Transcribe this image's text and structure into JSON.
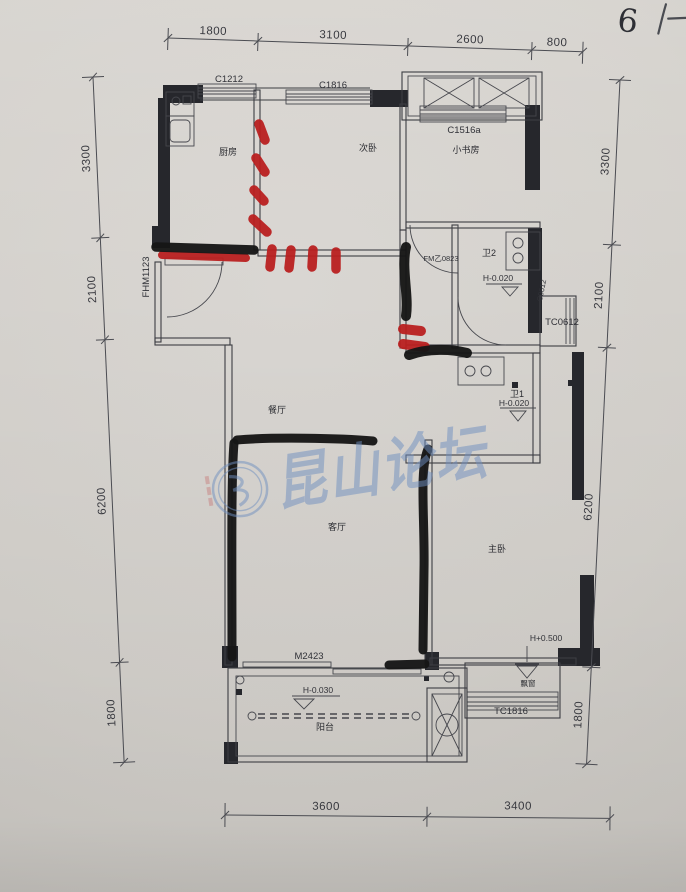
{
  "photo": {
    "handwritten_note": "6"
  },
  "watermark": {
    "text": "昆山论坛"
  },
  "rooms": {
    "kitchen": "厨房",
    "bedroom2": "次卧",
    "study": "小书房",
    "bath2": "卫2",
    "bath1": "卫1",
    "dining": "餐厅",
    "living": "客厅",
    "master": "主卧",
    "balcony": "阳台",
    "bay": "飘窗"
  },
  "openings": {
    "win_c1212": "C1212",
    "win_c1816": "C1816",
    "win_c1516a": "C1516a",
    "door_fhm1123": "FHM1123",
    "door_fm0823": "FM乙0823",
    "win_c0612": "C0612",
    "win_tc0612": "TC0612",
    "door_m2423": "M2423",
    "win_tc1816": "TC1816"
  },
  "levels": {
    "bath2": "H-0.020",
    "bath1": "H-0.020",
    "balcony": "H-0.030",
    "bay": "H+0.500"
  },
  "dimensions": {
    "top": [
      "1800",
      "3100",
      "2600",
      "800"
    ],
    "bottom": [
      "3600",
      "3400"
    ],
    "left": [
      "3300",
      "2100",
      "6200",
      "1800"
    ],
    "right": [
      "3300",
      "2100",
      "6200",
      "1800"
    ]
  },
  "colors": {
    "marker-red": "#b92020",
    "marker-black": "#161616",
    "watermark-blue": "#6f8fc0"
  }
}
